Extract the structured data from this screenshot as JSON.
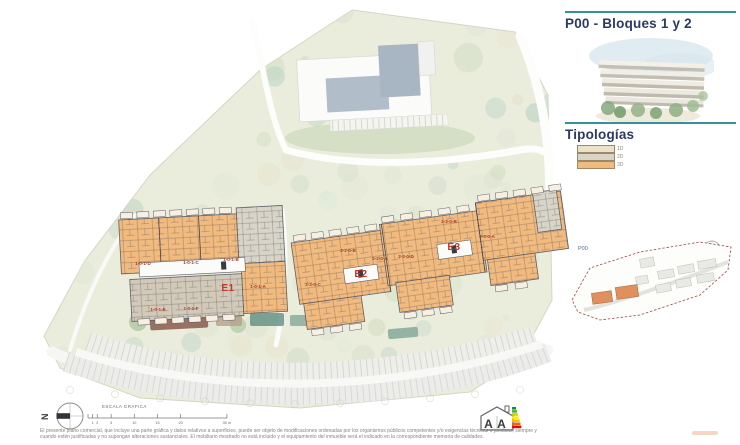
{
  "page": {
    "title": "P00 - Bloques 1 y 2",
    "tipologias_heading": "Tipologías",
    "north_letter": "N"
  },
  "colors": {
    "accent_teal": "#35929b",
    "title_navy": "#2b3a63",
    "unit_label_red": "#a63b2a",
    "block_label_red": "#c0392b",
    "plan_orange": "#f1ba7e",
    "plan_gray": "#d8d4c8",
    "plan_cream": "#ece2c9"
  },
  "legend": {
    "items": [
      {
        "label": "1D",
        "color": "#ece2c9"
      },
      {
        "label": "2D",
        "color": "#d8d5c7"
      },
      {
        "label": "3D",
        "color": "#f0bb7d"
      }
    ]
  },
  "keymap": {
    "label": "P00"
  },
  "scalebar": {
    "title": "ESCALA GRÁFICA",
    "ticks": [
      {
        "label": "1",
        "m": 1
      },
      {
        "label": "2",
        "m": 2
      },
      {
        "label": "5",
        "m": 5
      },
      {
        "label": "10",
        "m": 10
      },
      {
        "label": "15",
        "m": 15
      },
      {
        "label": "20",
        "m": 20
      },
      {
        "label": "30 m",
        "m": 30
      }
    ]
  },
  "plan": {
    "block_labels": [
      {
        "text": "E1",
        "x": 228,
        "y": 291
      },
      {
        "text": "E2",
        "x": 361,
        "y": 277
      },
      {
        "text": "E3",
        "x": 454,
        "y": 250
      }
    ],
    "unit_labels": [
      {
        "text": "1-0-1-D",
        "x": 143,
        "y": 265
      },
      {
        "text": "1-0-1-C",
        "x": 191,
        "y": 264
      },
      {
        "text": "1-0-1-B",
        "x": 231,
        "y": 261
      },
      {
        "text": "1-0-1-A",
        "x": 258,
        "y": 288
      },
      {
        "text": "1-0-1-E",
        "x": 158,
        "y": 311
      },
      {
        "text": "1-0-1-F",
        "x": 191,
        "y": 310
      },
      {
        "text": "2-3-0-C",
        "x": 313,
        "y": 286
      },
      {
        "text": "2-2-0-B",
        "x": 348,
        "y": 252
      },
      {
        "text": "2-2-0-A",
        "x": 380,
        "y": 260
      },
      {
        "text": "2-3-0-D",
        "x": 406,
        "y": 258
      },
      {
        "text": "2-3-0-B",
        "x": 449,
        "y": 223
      },
      {
        "text": "2-3-0-A",
        "x": 487,
        "y": 238
      }
    ]
  },
  "footer": {
    "disclaimer_line1": "El presente plano comercial, que incluye una parte gráfica y datos relativos a superficies, puede ser objeto de modificaciones ordenadas por los organismos públicos competentes y/o exigencias técnicas o jurídicas, siempre y",
    "disclaimer_line2": "cuando estén justificadas y no supongan alteraciones sustanciales. El mobiliario mostrado no está incluido y el equipamiento del inmueble será el indicado en la correspondiente memoria de calidades.",
    "energy_letters": [
      "A",
      "A"
    ]
  }
}
